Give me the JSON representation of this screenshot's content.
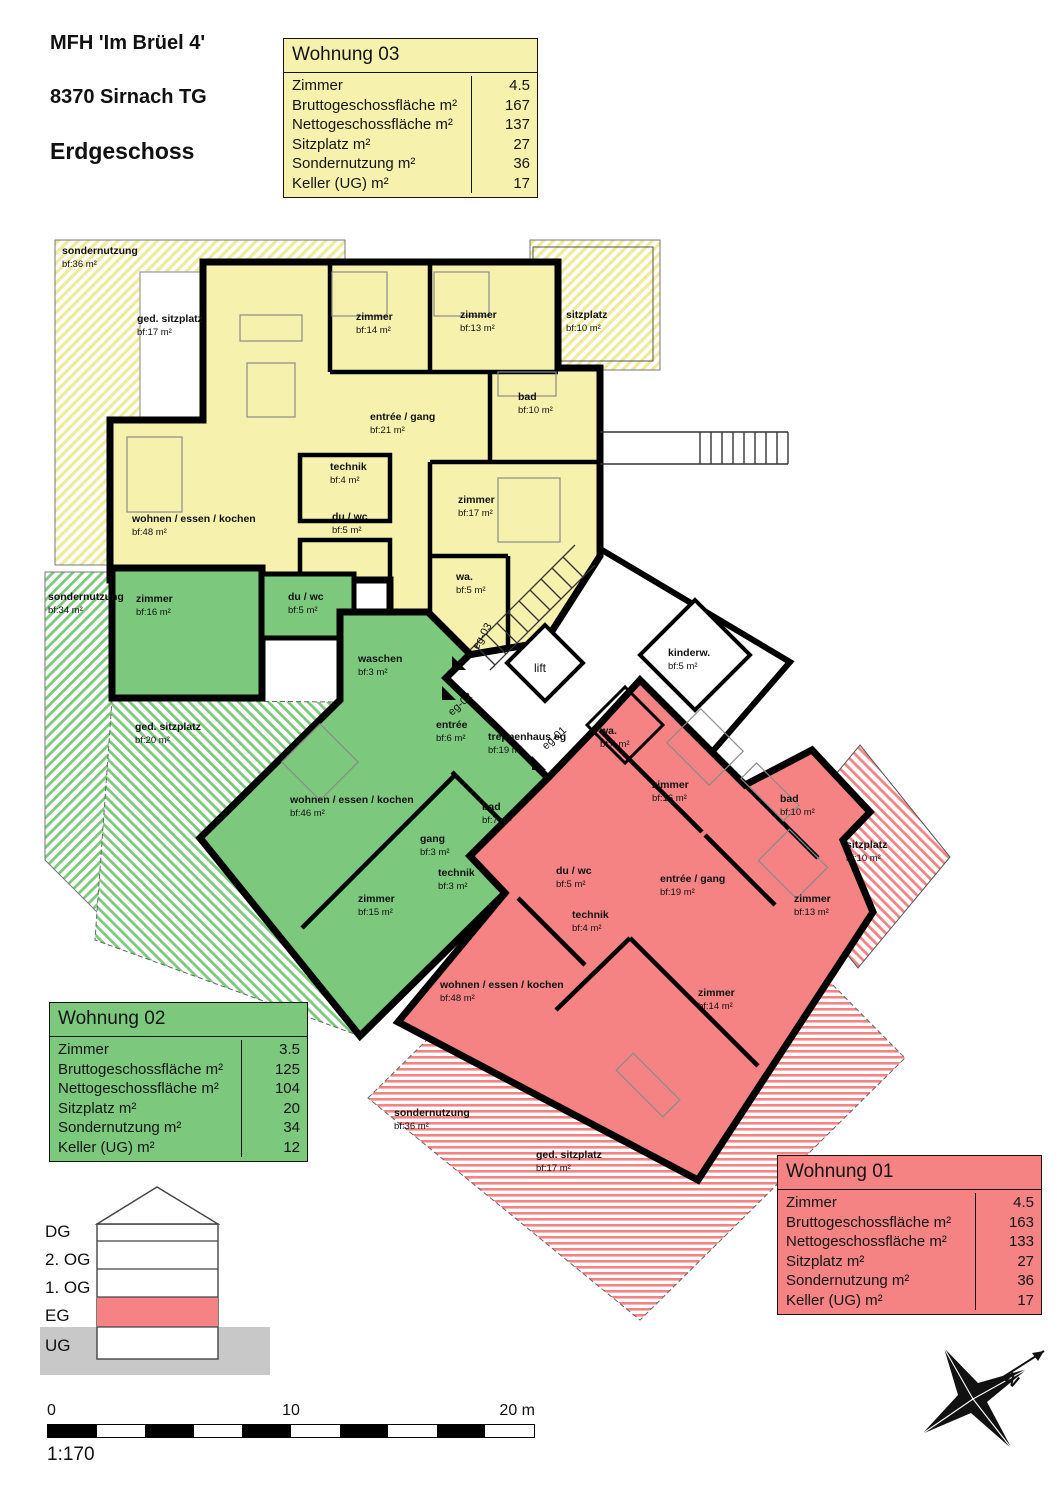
{
  "header": {
    "building": "MFH 'Im Brüel 4'",
    "address": "8370 Sirnach TG",
    "floor_title": "Erdgeschoss"
  },
  "apartment_tables": [
    {
      "id": "wohnung-03",
      "title": "Wohnung 03",
      "color": "#F6F2AE",
      "rows": [
        {
          "label": "Zimmer",
          "value": "4.5"
        },
        {
          "label": "Bruttogeschossfläche m²",
          "value": "167"
        },
        {
          "label": "Nettogeschossfläche m²",
          "value": "137"
        },
        {
          "label": "Sitzplatz m²",
          "value": "27"
        },
        {
          "label": "Sondernutzung m²",
          "value": "36"
        },
        {
          "label": "Keller (UG) m²",
          "value": "17"
        }
      ]
    },
    {
      "id": "wohnung-02",
      "title": "Wohnung 02",
      "color": "#7CC87D",
      "rows": [
        {
          "label": "Zimmer",
          "value": "3.5"
        },
        {
          "label": "Bruttogeschossfläche m²",
          "value": "125"
        },
        {
          "label": "Nettogeschossfläche m²",
          "value": "104"
        },
        {
          "label": "Sitzplatz m²",
          "value": "20"
        },
        {
          "label": "Sondernutzung m²",
          "value": "34"
        },
        {
          "label": "Keller (UG) m²",
          "value": "12"
        }
      ]
    },
    {
      "id": "wohnung-01",
      "title": "Wohnung 01",
      "color": "#F58384",
      "rows": [
        {
          "label": "Zimmer",
          "value": "4.5"
        },
        {
          "label": "Bruttogeschossfläche m²",
          "value": "163"
        },
        {
          "label": "Nettogeschossfläche m²",
          "value": "133"
        },
        {
          "label": "Sitzplatz m²",
          "value": "27"
        },
        {
          "label": "Sondernutzung m²",
          "value": "36"
        },
        {
          "label": "Keller (UG) m²",
          "value": "17"
        }
      ]
    }
  ],
  "plan": {
    "apartments": [
      {
        "id": "wohnung-03",
        "color": "#F6F2AE",
        "rooms": [
          {
            "label": "sondernutzung",
            "area": "bf:36 m²",
            "x": 62,
            "y": 254
          },
          {
            "label": "ged. sitzplatz",
            "area": "bf:17 m²",
            "x": 137,
            "y": 322
          },
          {
            "label": "zimmer",
            "area": "bf:14 m²",
            "x": 356,
            "y": 320
          },
          {
            "label": "zimmer",
            "area": "bf:13 m²",
            "x": 460,
            "y": 318
          },
          {
            "label": "sitzplatz",
            "area": "bf:10 m²",
            "x": 566,
            "y": 318
          },
          {
            "label": "entrée / gang",
            "area": "bf:21 m²",
            "x": 370,
            "y": 420
          },
          {
            "label": "bad",
            "area": "bf:10 m²",
            "x": 518,
            "y": 400
          },
          {
            "label": "technik",
            "area": "bf:4 m²",
            "x": 330,
            "y": 470
          },
          {
            "label": "du / wc",
            "area": "bf:5 m²",
            "x": 332,
            "y": 520
          },
          {
            "label": "wohnen / essen / kochen",
            "area": "bf:48 m²",
            "x": 132,
            "y": 522
          },
          {
            "label": "zimmer",
            "area": "bf:17 m²",
            "x": 458,
            "y": 503
          },
          {
            "label": "wa.",
            "area": "bf:5 m²",
            "x": 456,
            "y": 580
          }
        ]
      },
      {
        "id": "wohnung-02",
        "color": "#7CC87D",
        "rooms": [
          {
            "label": "sondernutzung",
            "area": "bf:34 m²",
            "x": 48,
            "y": 600
          },
          {
            "label": "zimmer",
            "area": "bf:16 m²",
            "x": 136,
            "y": 602
          },
          {
            "label": "du / wc",
            "area": "bf:5 m²",
            "x": 288,
            "y": 600
          },
          {
            "label": "waschen",
            "area": "bf:3 m²",
            "x": 358,
            "y": 662
          },
          {
            "label": "entrée",
            "area": "bf:6 m²",
            "x": 436,
            "y": 728
          },
          {
            "label": "ged. sitzplatz",
            "area": "bf:20 m²",
            "x": 135,
            "y": 730
          },
          {
            "label": "wohnen / essen / kochen",
            "area": "bf:46 m²",
            "x": 290,
            "y": 803
          },
          {
            "label": "gang",
            "area": "bf:3 m²",
            "x": 420,
            "y": 842
          },
          {
            "label": "bad",
            "area": "bf:7 m²",
            "x": 482,
            "y": 810
          },
          {
            "label": "technik",
            "area": "bf:3 m²",
            "x": 438,
            "y": 876
          },
          {
            "label": "zimmer",
            "area": "bf:15 m²",
            "x": 358,
            "y": 902
          }
        ]
      },
      {
        "id": "wohnung-01",
        "color": "#F58384",
        "rooms": [
          {
            "label": "wa.",
            "area": "bf:4 m²",
            "x": 600,
            "y": 734
          },
          {
            "label": "zimmer",
            "area": "bf:16 m²",
            "x": 652,
            "y": 788
          },
          {
            "label": "bad",
            "area": "bf:10 m²",
            "x": 780,
            "y": 802
          },
          {
            "label": "sitzplatz",
            "area": "bf:10 m²",
            "x": 846,
            "y": 848
          },
          {
            "label": "entrée / gang",
            "area": "bf:19 m²",
            "x": 660,
            "y": 882
          },
          {
            "label": "zimmer",
            "area": "bf:13 m²",
            "x": 794,
            "y": 902
          },
          {
            "label": "du / wc",
            "area": "bf:5 m²",
            "x": 556,
            "y": 874
          },
          {
            "label": "technik",
            "area": "bf:4 m²",
            "x": 572,
            "y": 918
          },
          {
            "label": "zimmer",
            "area": "bf:14 m²",
            "x": 698,
            "y": 996
          },
          {
            "label": "wohnen / essen / kochen",
            "area": "bf:48 m²",
            "x": 440,
            "y": 988
          },
          {
            "label": "sondernutzung",
            "area": "bf:36 m²",
            "x": 394,
            "y": 1116
          },
          {
            "label": "ged. sitzplatz",
            "area": "bf:17 m²",
            "x": 536,
            "y": 1158
          }
        ]
      }
    ],
    "common_rooms": [
      {
        "label": "lift",
        "area": "",
        "x": 534,
        "y": 672,
        "bold": false
      },
      {
        "label": "treppenhaus eg",
        "area": "bf:19 m²",
        "x": 488,
        "y": 740
      },
      {
        "label": "kinderw.",
        "area": "bf:5 m²",
        "x": 668,
        "y": 656
      }
    ],
    "door_labels": [
      {
        "label": "eg-03",
        "x": 478,
        "y": 650,
        "rot": -60
      },
      {
        "label": "eg-02",
        "x": 452,
        "y": 716,
        "rot": -42
      },
      {
        "label": "eg-01",
        "x": 546,
        "y": 750,
        "rot": -42
      }
    ]
  },
  "section": {
    "floors": [
      "DG",
      "2. OG",
      "1. OG",
      "EG",
      "UG"
    ],
    "highlighted_floor": "EG",
    "highlight_color": "#F58384",
    "ground_color": "#C8C8C8"
  },
  "scale_bar": {
    "start": "0",
    "mid": "10",
    "end": "20 m",
    "ratio": "1:170"
  },
  "compass": {
    "label": "N"
  }
}
